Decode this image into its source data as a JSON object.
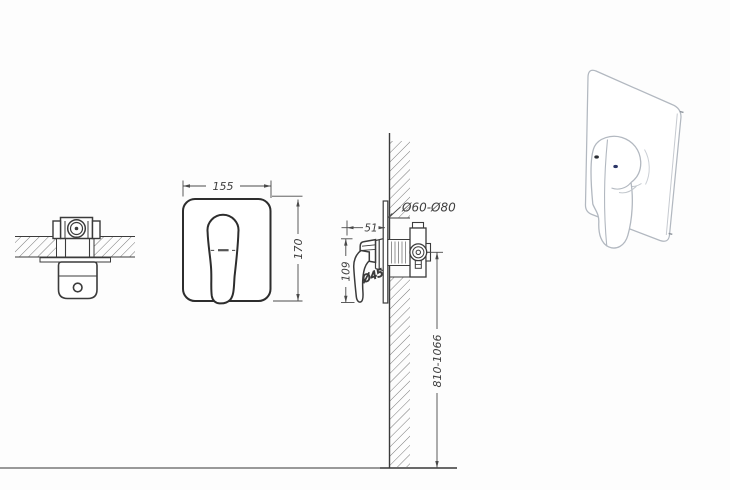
{
  "drawing": {
    "dimensions": {
      "plate_width": "155",
      "plate_height": "170",
      "handle_depth": "51",
      "lever_length": "109",
      "escutcheon_diameter": "Ø45",
      "wall_hole_diameter": "Ø60-Ø80",
      "install_height": "810-1066"
    },
    "colors": {
      "line": "#3b3b3b",
      "dimension_line": "#4a4a4a",
      "hatch": "#606060",
      "floor": "#999999",
      "perspective_line": "#b2b8c0",
      "indicator_dot_dark": "#2a2d33",
      "indicator_dot_blue": "#2b3566"
    }
  }
}
